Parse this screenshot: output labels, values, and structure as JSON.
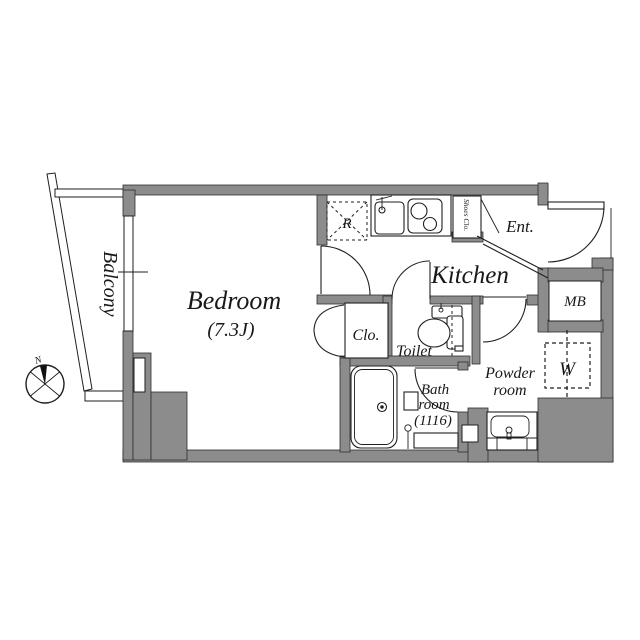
{
  "plan": {
    "type": "apartment-floor-plan",
    "colors": {
      "wall": "#8c8c8c",
      "line": "#1f1f1f",
      "background": "#ffffff"
    },
    "labels": {
      "balcony": "Balcony",
      "bedroom_name": "Bedroom",
      "bedroom_size": "(7.3J)",
      "kitchen": "Kitchen",
      "entrance": "Ent.",
      "shoes_closet": "Shoes Clo.",
      "meter_box": "MB",
      "washer": "W",
      "powder_line1": "Powder",
      "powder_line2": "room",
      "toilet": "Toilet",
      "closet": "Clo.",
      "bath_line1": "Bath",
      "bath_line2": "room",
      "bath_line3": "(1116)",
      "refrigerator": "R",
      "north": "N"
    }
  }
}
